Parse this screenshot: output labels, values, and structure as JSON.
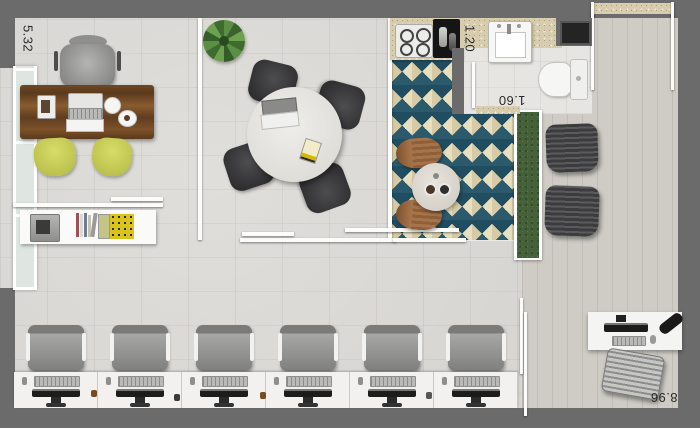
{
  "dimensions": {
    "left_wall": "5.32",
    "bathroom_width": "1.20",
    "bathroom_length": "1.60",
    "bottom_wall": "8.96"
  },
  "palette": {
    "exterior_wall": "#6b6b6b",
    "main_floor": "#d8d6d2",
    "rug_teal": "#2b5a6d",
    "rug_cream": "#e8dfbf",
    "desk_wood": "#6f4823",
    "guest_chair_yellow": "#c9cf53",
    "hedge_green": "#46613a",
    "furniture_white": "#f2f1ef"
  },
  "furniture_counts": {
    "workstations": 6,
    "meeting_chairs": 4,
    "guest_chairs": 2,
    "lounge_armchairs": 2,
    "cafe_chairs": 2
  }
}
